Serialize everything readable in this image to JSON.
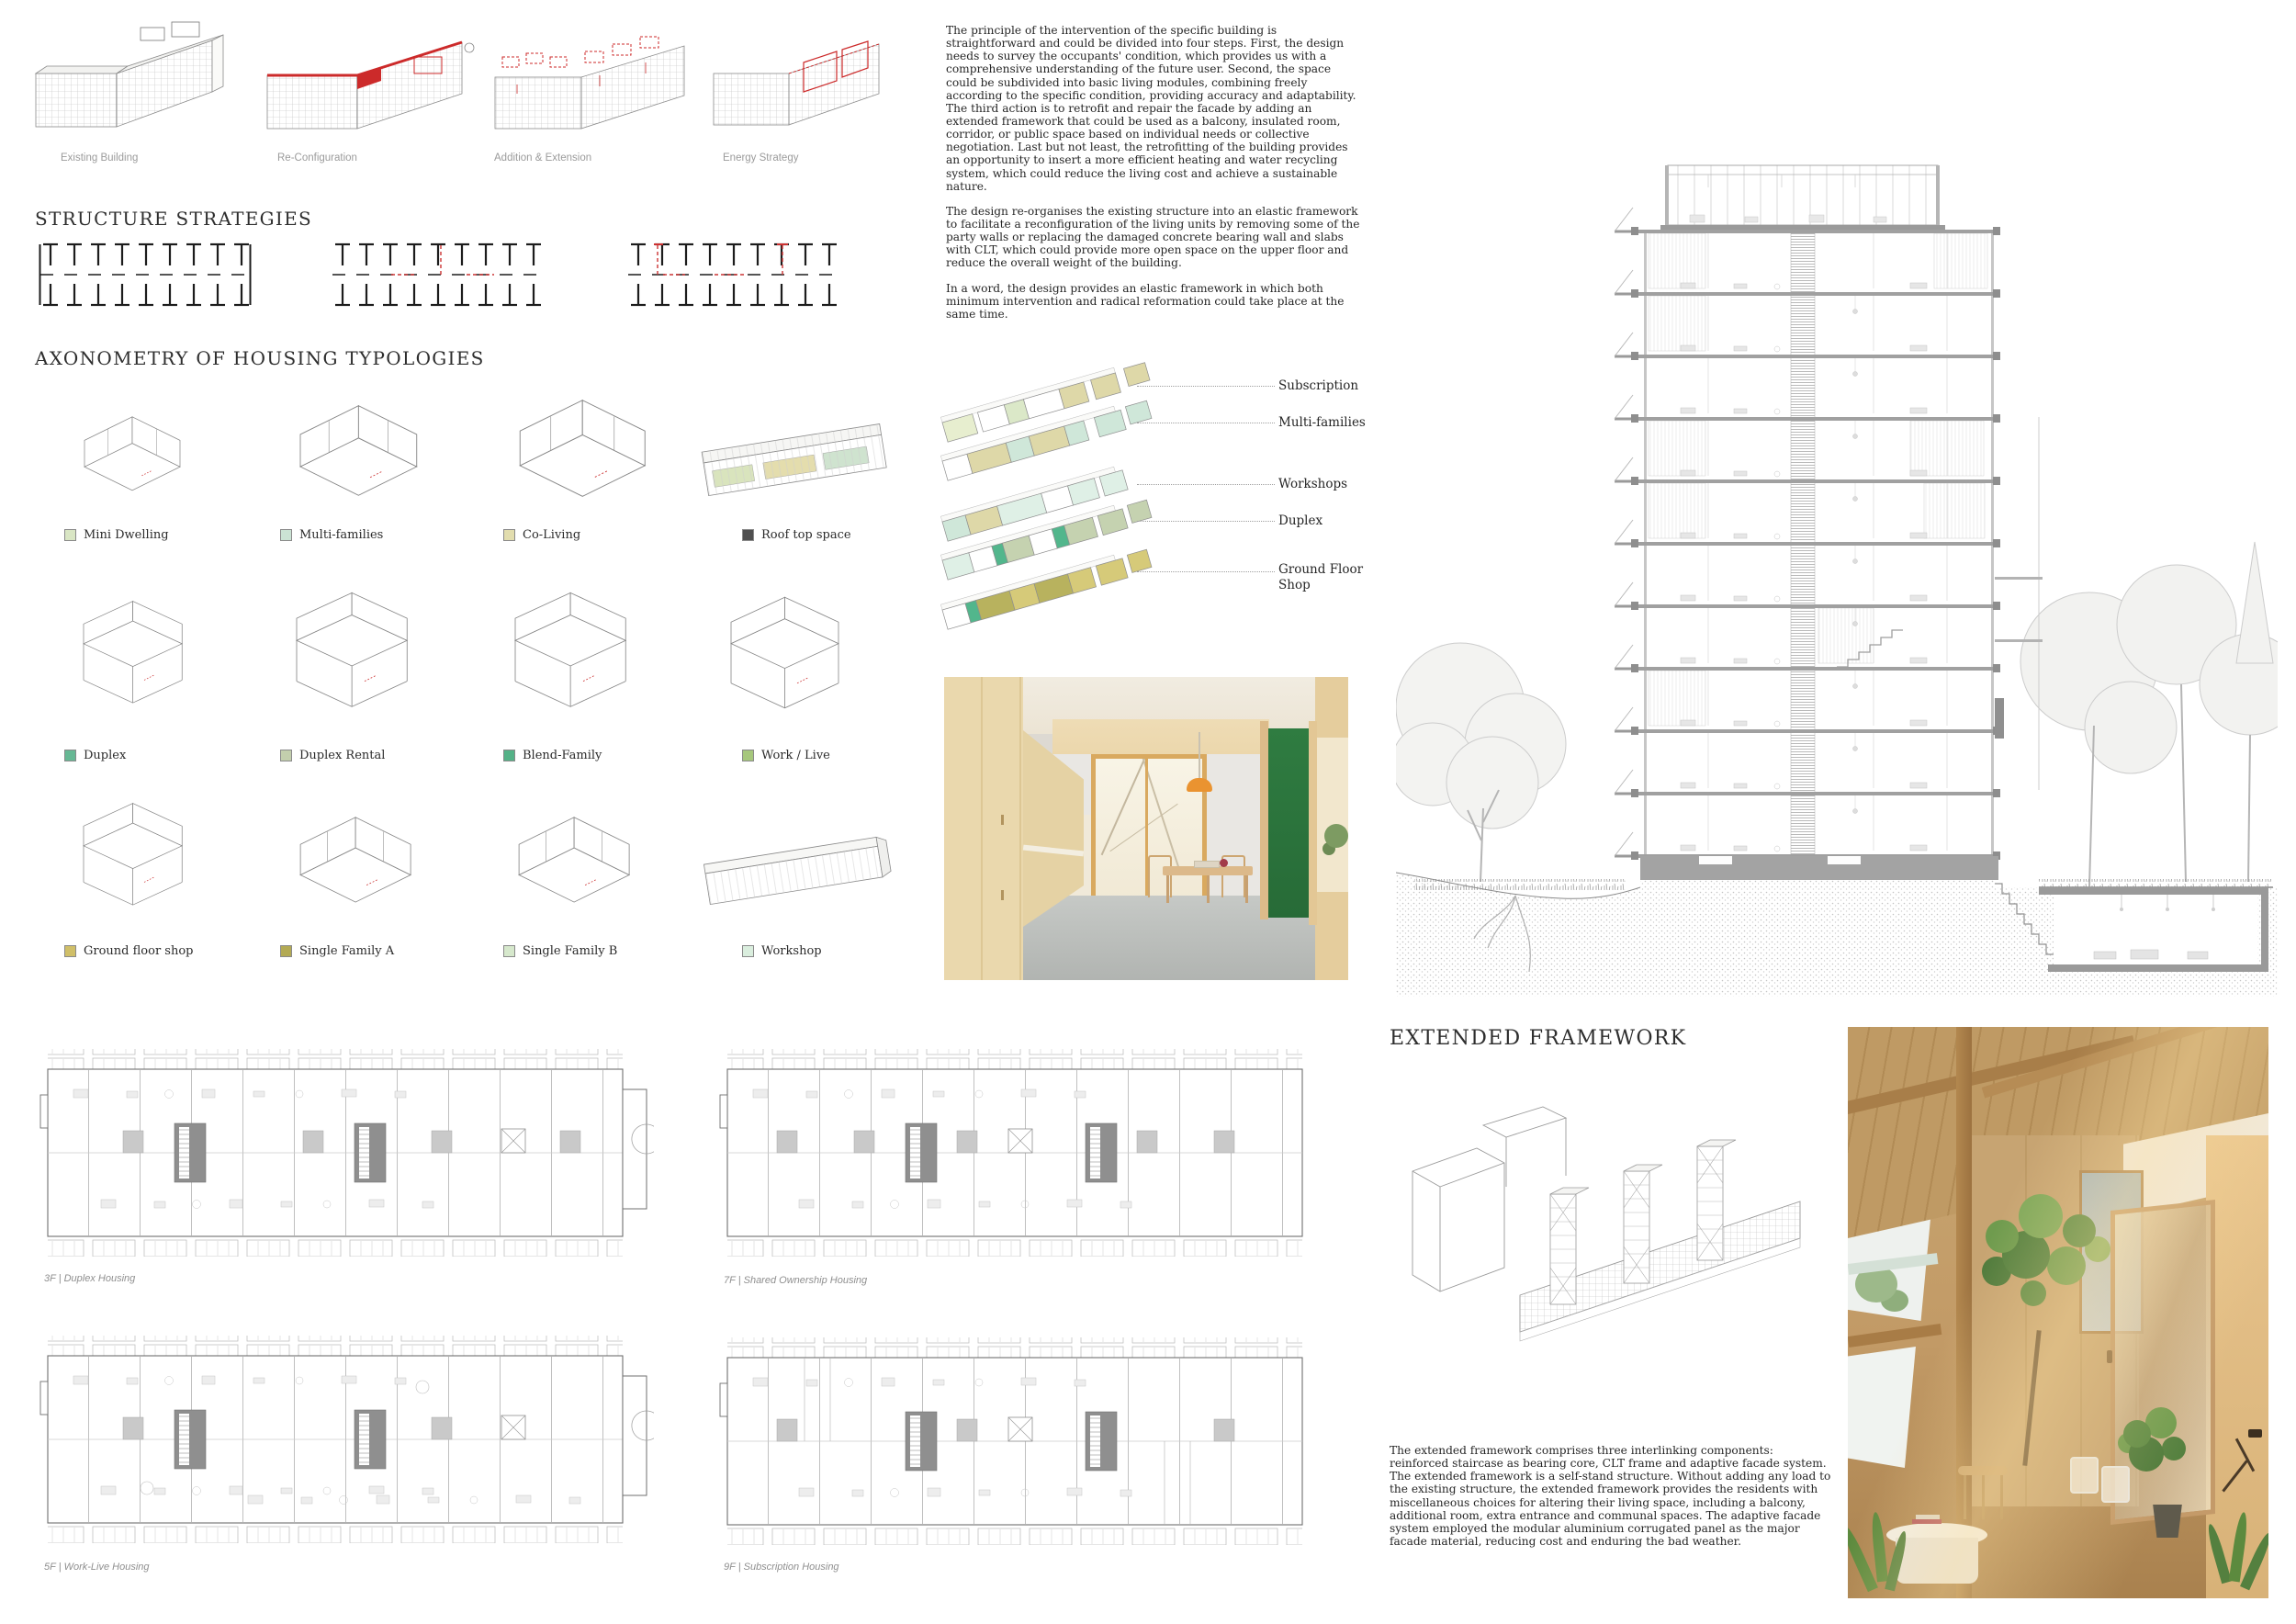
{
  "top_diagrams": {
    "labels": [
      "Existing Building",
      "Re-Configuration",
      "Addition & Extension",
      "Energy Strategy"
    ]
  },
  "intro": {
    "p1": "The principle of the intervention of the specific building is straightforward and could be divided into four steps. First, the design needs to survey the occupants' condition, which provides us with a comprehensive understanding of the future user. Second, the space could be subdivided into basic living modules, combining freely according to the specific condition, providing accuracy and adaptability. The third action is to retrofit and repair the facade by adding an extended framework that could be used as a balcony, insulated room, corridor, or public space based on individual needs or collective negotiation. Last but not least, the retrofitting of the building provides an opportunity to insert a more efficient heating and water recycling system, which could reduce the living cost and achieve a sustainable nature.",
    "p2": "The design re-organises the existing structure into an elastic framework to facilitate a reconfiguration of the living units by removing some of the party walls or replacing the damaged concrete bearing wall and slabs with CLT, which could provide more open space on the upper floor and reduce the overall weight of the building.",
    "p3": "In a word, the design provides an elastic framework in which both minimum intervention and radical reformation could take place at the same time."
  },
  "structure": {
    "heading": "STRUCTURE STRATEGIES"
  },
  "axonometry": {
    "heading": "AXONOMETRY OF HOUSING TYPOLOGIES",
    "typologies": [
      {
        "label": "Mini Dwelling",
        "color": "#d9e6c4"
      },
      {
        "label": "Multi-families",
        "color": "#cbe3d4"
      },
      {
        "label": "Co-Living",
        "color": "#e2ddae"
      },
      {
        "label": "Roof top space",
        "color": "#4f4f4f"
      },
      {
        "label": "Duplex",
        "color": "#66b894"
      },
      {
        "label": "Duplex Rental",
        "color": "#c3cfad"
      },
      {
        "label": "Blend-Family",
        "color": "#54b287"
      },
      {
        "label": "Work / Live",
        "color": "#a6c77c"
      },
      {
        "label": "Ground floor shop",
        "color": "#d0bf68"
      },
      {
        "label": "Single Family A",
        "color": "#b3aa54"
      },
      {
        "label": "Single Family B",
        "color": "#d6e8cc"
      },
      {
        "label": "Workshop",
        "color": "#daeede"
      }
    ]
  },
  "exploded": {
    "labels": [
      "Subscription",
      "Multi-families",
      "Workshops",
      "Duplex",
      "Ground Floor Shop"
    ]
  },
  "extended": {
    "heading": "EXTENDED FRAMEWORK",
    "paragraph": "The extended framework comprises three interlinking components: reinforced staircase as bearing core, CLT frame and adaptive facade system. The extended framework is a self-stand structure. Without adding any load to the existing structure, the extended framework provides the residents with miscellaneous choices for altering their living space, including a balcony, additional room, extra entrance and communal spaces. The adaptive facade system employed the modular aluminium corrugated panel as the major facade material, reducing cost and enduring the bad weather."
  },
  "plans": {
    "captions": [
      "3F | Duplex Housing",
      "7F | Shared Ownership Housing",
      "5F | Work-Live Housing",
      "9F | Subscription Housing"
    ]
  },
  "colors": {
    "accent_red": "#cc2a2a",
    "module_beige": "#ded8a8",
    "module_mint": "#cfe7d9",
    "module_teal": "#52b68c",
    "module_olive": "#b8b25e",
    "module_sage": "#c5d2b0",
    "module_palegreen": "#e7eecf"
  }
}
